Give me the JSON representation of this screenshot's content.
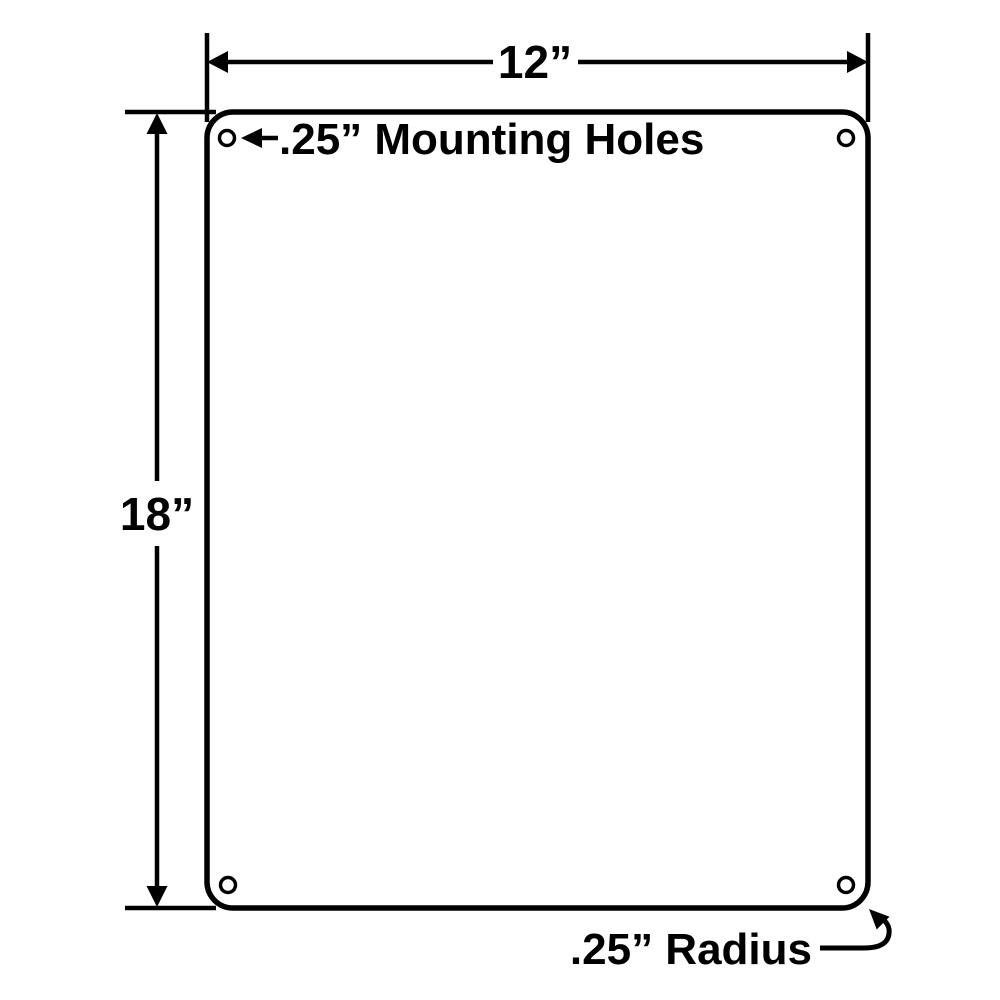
{
  "diagram": {
    "title": "sign-panel-dimension-drawing",
    "background_color": "#ffffff",
    "line_color": "#000000",
    "labels": {
      "width": "12”",
      "height": "18”",
      "mounting_holes": ".25” Mounting Holes",
      "corner_radius": ".25” Radius"
    },
    "plate": {
      "width_value": "12”",
      "height_value": "18”",
      "hole_diameter": ".25”",
      "corner_radius_value": ".25”",
      "hole_count": 4
    }
  }
}
